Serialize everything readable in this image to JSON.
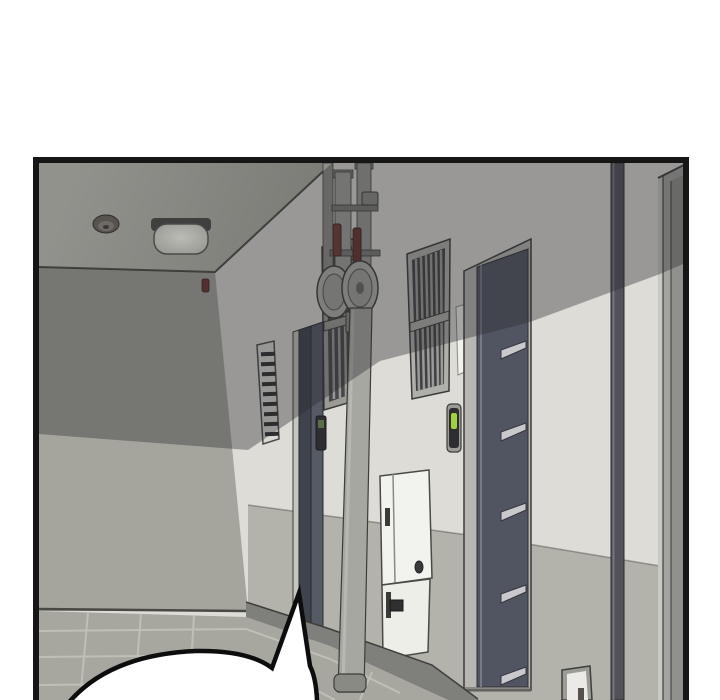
{
  "scene": {
    "type": "webtoon-comic-panel",
    "setting": "3D-rendered apartment corridor: gray ceiling with dome lamp and smoke detector, cream wall with steel doors, barred security windows, fire standpipes with alarm gongs, electrical cabinet, tiled floor; empty speech bubble cropped at bottom",
    "speech_bubble_text": "",
    "objects": [
      "ceiling-lamp",
      "smoke-detector",
      "fire-alarm-bell",
      "ventilation-louver",
      "barred-window-far",
      "barred-window-near",
      "standpipe-riser",
      "alarm-gong-discs",
      "steel-door-far-with-keypad",
      "steel-door-near-with-louver-plates",
      "recessed-light-slit",
      "card-reader-green-led",
      "electrical-cabinet-upper",
      "electrical-cabinet-lower",
      "drain-pipe",
      "alcove-doorway",
      "wall-outlet-box",
      "tiled-floor",
      "speech-bubble"
    ]
  },
  "colors": {
    "page_bg": "#ffffff",
    "panel_border": "#161616",
    "ceiling": "#8a8a85",
    "wall_lit": "#dedcd6",
    "end_wall": "#a5a59d",
    "wainscot": "#b3b3ab",
    "floor": "#a7a7a0",
    "tile_joint": "#c6c6be",
    "baseboard": "#7f7f7b",
    "shadow": "rgba(42,42,48,0.38)",
    "door_panel": "#515561",
    "door_frame": "#b7b7b3",
    "dark_door": "#565a64",
    "pipe": "#a7a7a1",
    "metal_plate": "#c9c9cd",
    "valve_red": "#6e3c34",
    "alarm_red": "#693430",
    "led_green": "#9fd23e",
    "cabinet_white": "#f2f2ee",
    "bubble_fill": "#ffffff",
    "bubble_stroke": "#0d0d0d"
  }
}
